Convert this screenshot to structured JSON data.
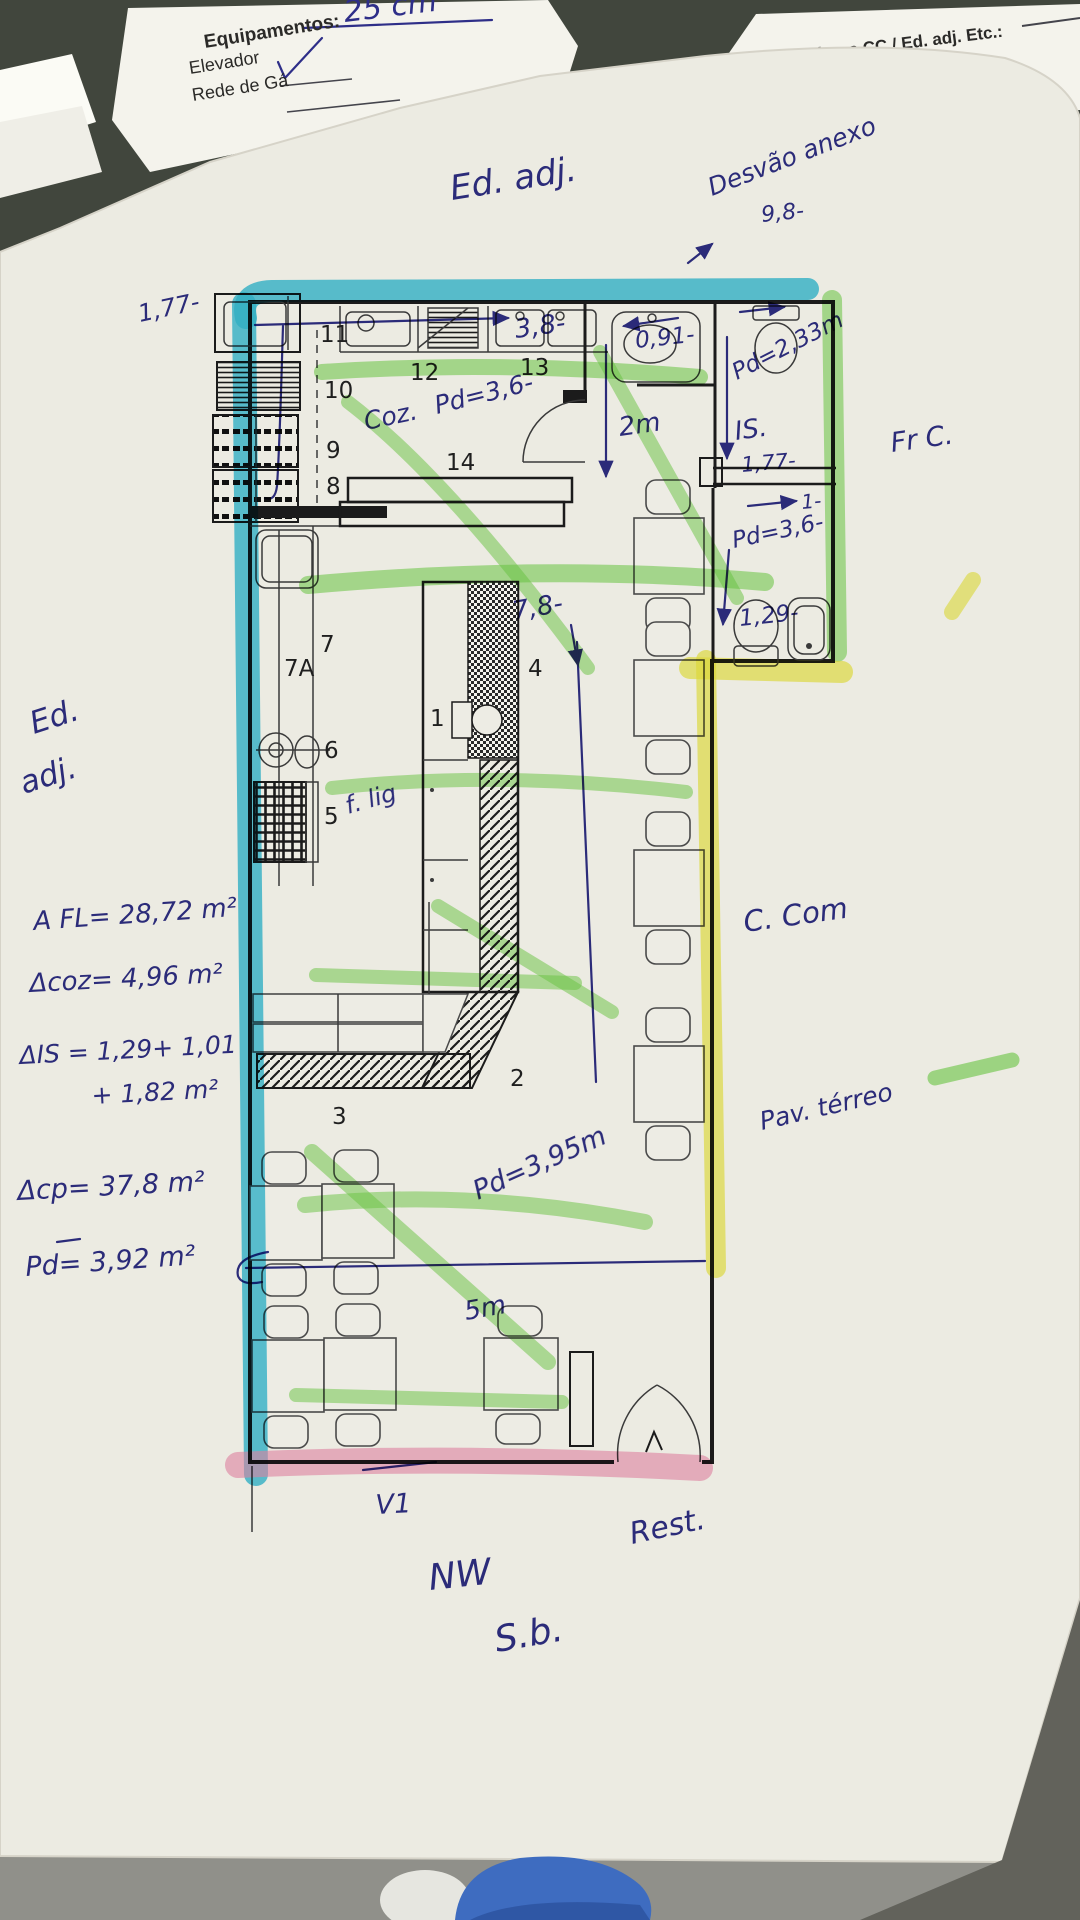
{
  "underlying_documents": {
    "left_sheet": {
      "top_note": "25 cm",
      "title": "Equipamentos:",
      "item_1": "Elevador",
      "item_2": "Rede de Gá",
      "checkmark_icon": "check"
    },
    "right_sheet": {
      "header": "teriores CC / Ed. adj. Etc.:",
      "field_label": "ra:",
      "field_value": "15cm"
    }
  },
  "plan": {
    "rooms": {
      "n1": "1",
      "n2": "2",
      "n3": "3",
      "n4": "4",
      "n5": "5",
      "n6": "6",
      "n7": "7",
      "n7a": "7A",
      "n8": "8",
      "n9": "9",
      "n10": "10",
      "n11": "11",
      "n12": "12",
      "n13": "13",
      "n14": "14"
    },
    "annotations": {
      "ed_adj_top": "Ed. adj.",
      "desvao": "Desvão anexo",
      "dim_9_8": "9,8-",
      "dim_3_8": "3,8-",
      "dim_1_77_left": "1,77-",
      "coz": "Coz.",
      "pd_kitchen": "Pd=3,6-",
      "dim_0_91": "0,91-",
      "dim_2m": "2m",
      "pd_wc1": "Pd=2,33m",
      "is": "IS.",
      "dim_1_77_is": "1,77-",
      "fr_c": "Fr C.",
      "dim_1": "1-",
      "pd_wc2": "Pd=3,6-",
      "dim_1_29": "1,29-",
      "dim_7_8": "7,8-",
      "f_lig": "f. lig",
      "ed_left_a": "Ed.",
      "ed_left_b": "adj.",
      "c_com": "C. Com",
      "pav_terreo": "Pav. térreo",
      "pd_salon": "Pd=3,95m",
      "dim_5m": "5m",
      "v1": "V1",
      "nw": "NW",
      "sb": "S.b.",
      "rest": "Rest."
    },
    "calcs": {
      "afl": "A FL= 28,72 m²",
      "acoz": "Δcoz= 4,96 m²",
      "ais_a": "ΔIS = 1,29+ 1,01",
      "ais_b": "+ 1,82 m²",
      "acp": "Δcp= 37,8 m²",
      "pd": "Pd= 3,92 m²"
    },
    "highlight_colors": {
      "cyan": "#36bedd",
      "green": "#70d348",
      "yellow": "#ece93e",
      "pink": "#f08cb4",
      "ink": "#2e2e88"
    }
  }
}
